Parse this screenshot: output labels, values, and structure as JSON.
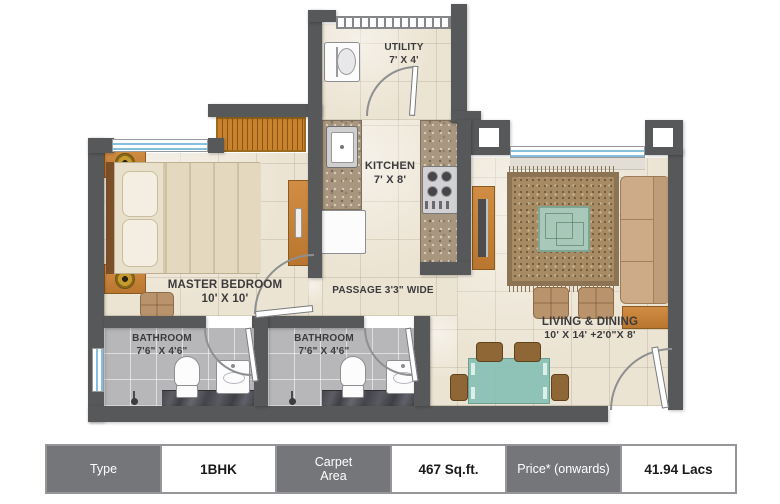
{
  "plan": {
    "rooms": {
      "utility": {
        "name": "UTILITY",
        "dims": "7' X 4'"
      },
      "kitchen": {
        "name": "KITCHEN",
        "dims": "7' X 8'"
      },
      "master_bedroom": {
        "name": "MASTER BEDROOM",
        "dims": "10' X 10'"
      },
      "passage": {
        "name": "PASSAGE 3'3\" WIDE"
      },
      "bathroom_1": {
        "name": "BATHROOM",
        "dims": "7'6\" X 4'6\""
      },
      "bathroom_2": {
        "name": "BATHROOM",
        "dims": "7'6\" X 4'6\""
      },
      "living_dining": {
        "name": "LIVING & DINING",
        "dims": "10' X 14' +2'0\"X 8'"
      }
    },
    "fixtures": [
      "double-bed",
      "nightstand-lamp",
      "wardrobe",
      "dresser",
      "ottoman",
      "washing-machine",
      "kitchen-sink",
      "gas-stove",
      "refrigerator",
      "toilet",
      "wash-basin",
      "shower-drain",
      "sofa",
      "side-table",
      "tv-unit",
      "rug",
      "coffee-table",
      "pouf",
      "dining-table",
      "dining-chair",
      "door-swing",
      "window"
    ],
    "colors": {
      "wall": "#57585a",
      "floor": "#ece4d3",
      "bathroom_floor": "#b7b7b9",
      "wood": "#c8823c",
      "granite": "#a8967f",
      "rug": "#a68b64",
      "teal_glass": "#88c0b4",
      "window_blue": "#86bede",
      "marble_dark": "#4a4a50",
      "table_header": "#757679"
    }
  },
  "spec_table": {
    "cells": [
      {
        "label": "Type",
        "header": true
      },
      {
        "label": "1BHK",
        "header": false
      },
      {
        "label": "Carpet\nArea",
        "header": true
      },
      {
        "label": "467 Sq.ft.",
        "header": false
      },
      {
        "label": "Price* (onwards)",
        "header": true
      },
      {
        "label": "41.94 Lacs",
        "header": false
      }
    ]
  }
}
